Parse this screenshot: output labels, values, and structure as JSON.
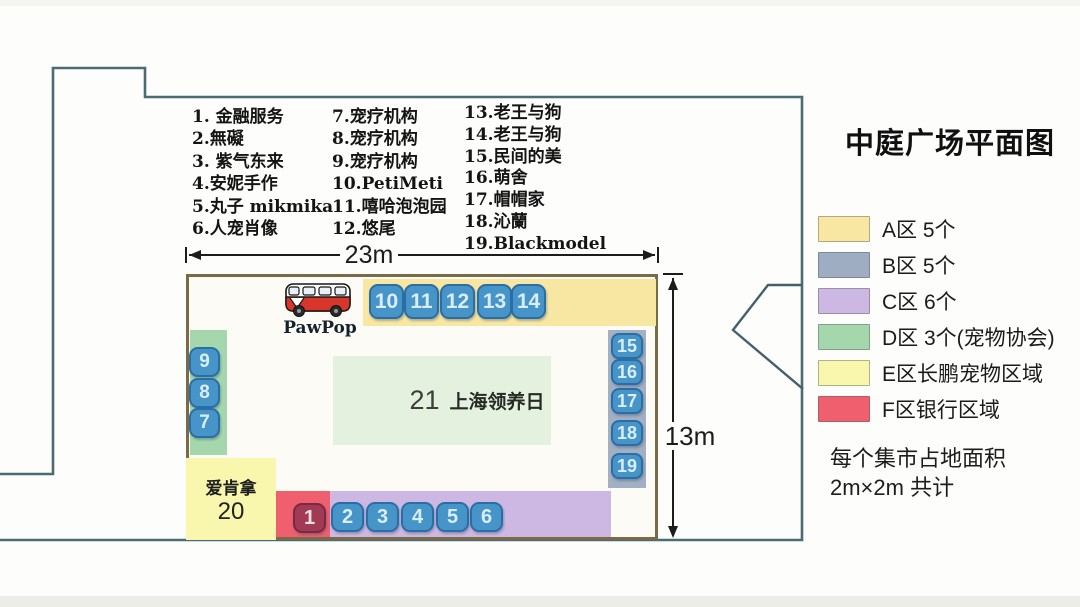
{
  "title": "中庭广场平面图",
  "vendors": {
    "col1": [
      "1. 金融服务",
      "2.無礙",
      "3. 紫气东来",
      "4.安妮手作",
      "5.丸子 mikmika",
      "6.人宠肖像"
    ],
    "col2": [
      "7.宠疗机构",
      "8.宠疗机构",
      "9.宠疗机构",
      "10.PetiMeti",
      "11.嘻哈泡泡园",
      "12.悠尾"
    ],
    "col3": [
      "13.老王与狗",
      "14.老王与狗",
      "15.民间的美",
      "16.萌舍",
      "17.帽帽家",
      "18.沁蘭",
      "19.Blackmodel"
    ]
  },
  "dimensions": {
    "width_label": "23m",
    "height_label": "13m"
  },
  "plan": {
    "bus_label": "PawPop",
    "center_area": {
      "number": "21",
      "label": "上海领养日"
    },
    "zone_e_block": {
      "name": "爱肯拿",
      "number": "20"
    },
    "booths_top": [
      "10",
      "11",
      "12",
      "13",
      "14"
    ],
    "booths_right": [
      "15",
      "16",
      "17",
      "18",
      "19"
    ],
    "booths_left": [
      "9",
      "8",
      "7"
    ],
    "booth_f": "1",
    "booths_bottom": [
      "2",
      "3",
      "4",
      "5",
      "6"
    ]
  },
  "legend": {
    "items": [
      {
        "label": "A区 5个",
        "color": "#f7e7a2"
      },
      {
        "label": "B区 5个",
        "color": "#9fadc2"
      },
      {
        "label": "C区 6个",
        "color": "#ccb8e2"
      },
      {
        "label": "D区 3个(宠物协会)",
        "color": "#a4d8ac"
      },
      {
        "label": "E区长鹏宠物区域",
        "color": "#f9f7ad"
      },
      {
        "label": "F区银行区域",
        "color": "#ef5f6e"
      }
    ]
  },
  "note": {
    "line1": "每个集市占地面积",
    "line2": "2m×2m 共计"
  },
  "colors": {
    "outline": "#4d6b75",
    "plan_border": "#7b6a47",
    "booth_blue": "#4795c8",
    "booth_blue_border": "#2a6ea5",
    "booth_red": "#a13a54",
    "zone_a": "#f7e7a2",
    "zone_b": "#a3b0c4",
    "zone_c": "#ccb8e2",
    "zone_d": "#a4d8ac",
    "zone_e": "#f9f7ad",
    "zone_f": "#ef5f6e",
    "adoption_green": "#e5f1df",
    "bus_red": "#d8362a"
  }
}
